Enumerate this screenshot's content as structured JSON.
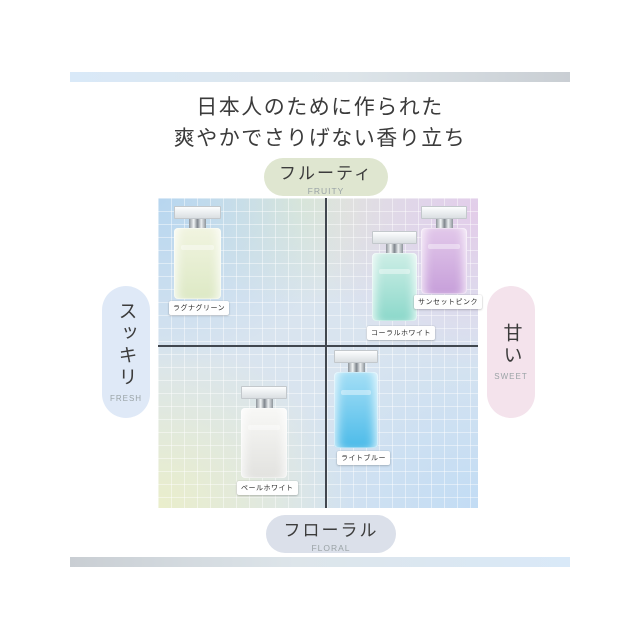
{
  "header": {
    "title_line1": "日本人のために作られた",
    "title_line2": "爽やかでさりげない香り立ち"
  },
  "decor": {
    "top_bar_gradient": [
      "#d9e9f8",
      "#c9ced3"
    ],
    "bottom_bar_gradient": [
      "#c9ced3",
      "#d9e9f8"
    ],
    "axis_line_color": "#41474f"
  },
  "chart_data": {
    "type": "scatter",
    "title": "日本人のために作られた 爽やかでさりげない香り立ち",
    "grid": true,
    "x_range": [
      -1,
      1
    ],
    "y_range": [
      -1,
      1
    ],
    "axes": {
      "y_top": {
        "label": "フルーティ",
        "sublabel": "FRUITY",
        "badge_color": "#dfe6d0"
      },
      "y_bottom": {
        "label": "フローラル",
        "sublabel": "FLORAL",
        "badge_color": "#dbe0ea"
      },
      "x_left": {
        "label": "スッキリ",
        "sublabel": "FRESH",
        "badge_color": "#dfe9f7"
      },
      "x_right": {
        "label": "甘い",
        "sublabel": "SWEET",
        "badge_color": "#f4e3ec"
      }
    },
    "points": [
      {
        "name": "ラグナグリーン",
        "x": -0.76,
        "y": 0.55,
        "bottle_color": "#e7eecf"
      },
      {
        "name": "コーラルホワイト",
        "x": 0.45,
        "y": 0.39,
        "bottle_color": "#9fdfd3"
      },
      {
        "name": "サンセットピンク",
        "x": 0.78,
        "y": 0.57,
        "bottle_color": "#cfa9df"
      },
      {
        "name": "ペールホワイト",
        "x": -0.37,
        "y": -0.53,
        "bottle_color": "#efefec"
      },
      {
        "name": "ライトブルー",
        "x": 0.2,
        "y": -0.34,
        "bottle_color": "#62c3ec"
      }
    ]
  }
}
